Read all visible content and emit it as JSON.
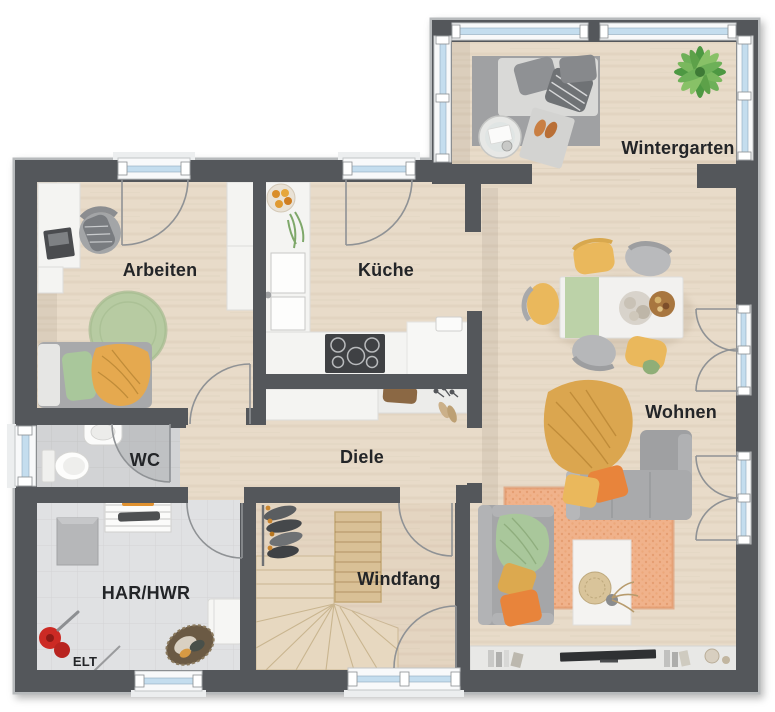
{
  "rooms": {
    "wintergarten": {
      "label": "Wintergarten"
    },
    "arbeiten": {
      "label": "Arbeiten"
    },
    "kueche": {
      "label": "Küche"
    },
    "wohnen": {
      "label": "Wohnen"
    },
    "wc": {
      "label": "WC"
    },
    "diele": {
      "label": "Diele"
    },
    "har_hwr": {
      "label": "HAR/HWR"
    },
    "windfang": {
      "label": "Windfang"
    },
    "elt": {
      "label": "ELT"
    }
  },
  "colors": {
    "wall": "#54575b",
    "outline": "#b7babc",
    "wood": "#e8dbc9",
    "wood_windfang": "#e4d5c1",
    "tile_wc": "#d2d3d5",
    "tile_har": "#e0e1e3",
    "window_glass": "#c4ddee",
    "window_frame": "#f8f9fa",
    "label": "#232528",
    "furniture_white": "#f4f4f2",
    "sofa_gray": "#a6a7a9",
    "accent_orange": "#e8843b",
    "accent_yellow": "#eab85c",
    "accent_green": "#a9c79b",
    "rug_orange": "#f0b28b",
    "rug_green": "#b7cba2",
    "stair_wood": "#e7d8c0",
    "plant_green": "#5da149"
  }
}
